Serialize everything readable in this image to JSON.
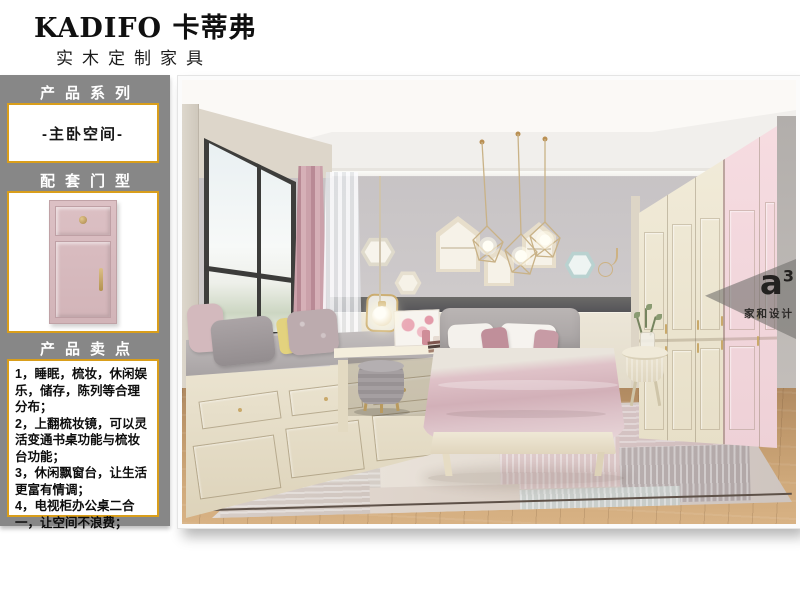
{
  "header": {
    "brand": "KADIFO 卡蒂弗",
    "subtitle": "实木定制家具"
  },
  "sidebar": {
    "series_label": "产品系列",
    "series_value": "-主卧空间-",
    "door_label": "配套门型",
    "selling_label": "产品卖点",
    "selling_points": [
      "1，睡眠，梳妆，休闲娱乐，储存，陈列等合理分布；",
      "2，上翻梳妆镜，可以灵活变通书桌功能与梳妆台功能；",
      "3，休闲飘窗台，让生活更富有情调；",
      "4，电视柜办公桌二合一，让空间不浪费；"
    ]
  },
  "watermark": {
    "logo_letter": "a",
    "logo_sup": "3",
    "brand_name": "家和设计"
  },
  "colors": {
    "accent_gold": "#d99e1b",
    "sidebar_gray": "#878787",
    "door_pink": "#d8bfc2",
    "wardrobe_pink": "#f2d7dc",
    "wardrobe_cream": "#efe8d5"
  }
}
